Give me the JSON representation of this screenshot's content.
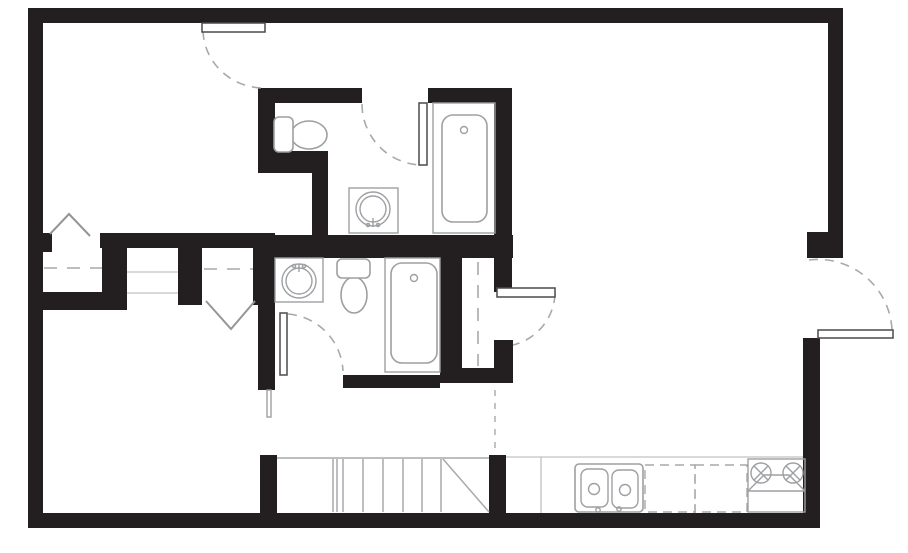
{
  "meta": {
    "title": "Residential floor plan drawing",
    "canvas_width": 908,
    "canvas_height": 553,
    "background": "#ffffff"
  },
  "colors": {
    "wall": "#231f20",
    "fixture_line": "#9d9fa2",
    "swing_arc": "#a7a9ac",
    "door_leaf_stroke": "#4a4a4c",
    "thin_line": "#b1b3b6",
    "background": "#ffffff"
  },
  "styles": {
    "wall": {
      "fill": "#231f20"
    },
    "leaf": {
      "fill": "#ffffff",
      "stroke": "#4a4a4c",
      "width": 1.5
    },
    "arc": {
      "stroke": "#a7a9ac",
      "width": 1.6,
      "dash": "9 7"
    },
    "chevron": {
      "stroke": "#939598",
      "width": 2
    },
    "shelf": {
      "stroke": "#a7a9ac",
      "width": 1.6,
      "dash": "13 10"
    },
    "dashsm": {
      "stroke": "#a7a9ac",
      "width": 1.4,
      "dash": "6 7"
    },
    "dashbox": {
      "stroke": "#a7a9ac",
      "width": 1.4,
      "dash": "9 6"
    },
    "fixture": {
      "fill": "#ffffff",
      "stroke": "#9d9fa2",
      "width": 1.6
    },
    "fixline": {
      "stroke": "#9d9fa2",
      "width": 1.4
    },
    "thin": {
      "stroke": "#b1b3b6",
      "width": 1.1
    },
    "tread": {
      "stroke": "#a7a9ac",
      "width": 1.5
    }
  },
  "layers": [
    {
      "name": "walls",
      "shapes": [
        {
          "n": "wall-exterior-top",
          "t": "rect",
          "x": 28,
          "y": 8,
          "width": 815,
          "height": 15,
          "st": "wall"
        },
        {
          "n": "wall-exterior-left",
          "t": "rect",
          "x": 28,
          "y": 8,
          "width": 15,
          "height": 520,
          "st": "wall"
        },
        {
          "n": "wall-exterior-bottom",
          "t": "rect",
          "x": 28,
          "y": 513,
          "width": 792,
          "height": 15,
          "st": "wall"
        },
        {
          "n": "wall-exterior-right-upper",
          "t": "rect",
          "x": 828,
          "y": 8,
          "width": 15,
          "height": 250,
          "st": "wall"
        },
        {
          "n": "wall-right-entry-jamb",
          "t": "rect",
          "x": 807,
          "y": 232,
          "width": 36,
          "height": 26,
          "st": "wall"
        },
        {
          "n": "wall-exterior-right-lower",
          "t": "rect",
          "x": 803,
          "y": 338,
          "width": 17,
          "height": 190,
          "st": "wall"
        },
        {
          "n": "wall-bath1-top-left",
          "t": "rect",
          "x": 258,
          "y": 88,
          "width": 104,
          "height": 15,
          "st": "wall"
        },
        {
          "n": "wall-bath1-top-right",
          "t": "rect",
          "x": 428,
          "y": 88,
          "width": 83,
          "height": 15,
          "st": "wall"
        },
        {
          "n": "wall-bath1-left",
          "t": "rect",
          "x": 258,
          "y": 88,
          "width": 17,
          "height": 63,
          "st": "wall"
        },
        {
          "n": "wall-bath1-jog-horizontal",
          "t": "rect",
          "x": 258,
          "y": 151,
          "width": 70,
          "height": 22,
          "st": "wall"
        },
        {
          "n": "wall-bath1-jog-vertical",
          "t": "rect",
          "x": 312,
          "y": 173,
          "width": 16,
          "height": 64,
          "st": "wall"
        },
        {
          "n": "wall-bath1-right",
          "t": "rect",
          "x": 494,
          "y": 88,
          "width": 18,
          "height": 204,
          "st": "wall"
        },
        {
          "n": "wall-middle-left",
          "t": "rect",
          "x": 100,
          "y": 233,
          "width": 175,
          "height": 15,
          "st": "wall"
        },
        {
          "n": "wall-middle-right",
          "t": "rect",
          "x": 263,
          "y": 235,
          "width": 250,
          "height": 23,
          "st": "wall"
        },
        {
          "n": "wall-closet1-door-stub",
          "t": "rect",
          "x": 43,
          "y": 233,
          "width": 9,
          "height": 19,
          "st": "wall"
        },
        {
          "n": "wall-closet1-right",
          "t": "rect",
          "x": 102,
          "y": 233,
          "width": 25,
          "height": 72,
          "st": "wall"
        },
        {
          "n": "wall-closet1-bottom",
          "t": "rect",
          "x": 43,
          "y": 292,
          "width": 84,
          "height": 18,
          "st": "wall"
        },
        {
          "n": "wall-hall-niche-right",
          "t": "rect",
          "x": 178,
          "y": 233,
          "width": 24,
          "height": 72,
          "st": "wall"
        },
        {
          "n": "wall-closet2-right",
          "t": "rect",
          "x": 253,
          "y": 235,
          "width": 15,
          "height": 70,
          "st": "wall"
        },
        {
          "n": "wall-bath2-left",
          "t": "rect",
          "x": 258,
          "y": 248,
          "width": 17,
          "height": 142,
          "st": "wall"
        },
        {
          "n": "wall-bath2-bottom",
          "t": "rect",
          "x": 343,
          "y": 375,
          "width": 97,
          "height": 13,
          "st": "wall"
        },
        {
          "n": "wall-bath2-right",
          "t": "rect",
          "x": 440,
          "y": 256,
          "width": 22,
          "height": 127,
          "st": "wall"
        },
        {
          "n": "wall-pantry-bottom",
          "t": "rect",
          "x": 440,
          "y": 368,
          "width": 73,
          "height": 15,
          "st": "wall"
        },
        {
          "n": "wall-pantry-right-lower",
          "t": "rect",
          "x": 494,
          "y": 340,
          "width": 19,
          "height": 43,
          "st": "wall"
        },
        {
          "n": "wall-stair-post-left",
          "t": "rect",
          "x": 260,
          "y": 455,
          "width": 17,
          "height": 58,
          "st": "wall"
        },
        {
          "n": "wall-stair-post-right",
          "t": "rect",
          "x": 489,
          "y": 455,
          "width": 17,
          "height": 58,
          "st": "wall"
        }
      ]
    },
    {
      "name": "closet-and-opening-details",
      "shapes": [
        {
          "n": "hall-niche-line-upper",
          "t": "line",
          "x1": 127,
          "y1": 272,
          "x2": 178,
          "y2": 272,
          "st": "thin"
        },
        {
          "n": "hall-niche-line-lower",
          "t": "line",
          "x1": 127,
          "y1": 293,
          "x2": 178,
          "y2": 293,
          "st": "thin"
        },
        {
          "n": "closet1-shelf-dashed",
          "t": "line",
          "x1": 44,
          "y1": 268,
          "x2": 102,
          "y2": 268,
          "st": "shelf"
        },
        {
          "n": "closet2-shelf-dashed",
          "t": "line",
          "x1": 204,
          "y1": 269,
          "x2": 253,
          "y2": 269,
          "st": "shelf"
        },
        {
          "n": "pantry-shelf-dashed",
          "t": "line",
          "x1": 478,
          "y1": 262,
          "x2": 478,
          "y2": 366,
          "st": "shelf"
        },
        {
          "n": "kitchen-boundary-dashed",
          "t": "line",
          "x1": 495,
          "y1": 390,
          "x2": 495,
          "y2": 453,
          "st": "dashsm"
        },
        {
          "n": "bath2-wall-end-cap",
          "t": "rect",
          "x": 267,
          "y": 390,
          "width": 4,
          "height": 27,
          "st": "fixline"
        }
      ]
    },
    {
      "name": "bathroom-upper-fixtures",
      "shapes": [
        {
          "n": "bath1-tub-enclosure",
          "t": "rect",
          "x": 433,
          "y": 103,
          "width": 62,
          "height": 130,
          "st": "fixline"
        },
        {
          "n": "bath1-bathtub",
          "t": "rect",
          "x": 442,
          "y": 115,
          "width": 45,
          "height": 107,
          "rx": 11,
          "st": "fixture"
        },
        {
          "n": "bath1-tub-faucet",
          "t": "circle",
          "cx": 464,
          "cy": 130,
          "r": 3.5,
          "st": "fixline"
        },
        {
          "n": "bath1-toilet-bowl",
          "t": "ellipse",
          "cx": 309,
          "cy": 135,
          "rx": 18,
          "ry": 14,
          "st": "fixture"
        },
        {
          "n": "bath1-toilet-tank",
          "t": "rect",
          "x": 274,
          "y": 117,
          "width": 19,
          "height": 35,
          "rx": 5,
          "st": "fixture"
        },
        {
          "n": "bath1-vanity",
          "t": "rect",
          "x": 349,
          "y": 188,
          "width": 49,
          "height": 45,
          "st": "fixline"
        },
        {
          "n": "bath1-sink-outer",
          "t": "circle",
          "cx": 373,
          "cy": 209,
          "r": 17,
          "st": "fixline"
        },
        {
          "n": "bath1-sink-inner",
          "t": "circle",
          "cx": 373,
          "cy": 209,
          "r": 13,
          "st": "fixline"
        },
        {
          "n": "bath1-sink-faucet-stem",
          "t": "line",
          "x1": 373,
          "y1": 218,
          "x2": 373,
          "y2": 227,
          "st": "fixline"
        },
        {
          "n": "bath1-sink-faucet-dot-left",
          "t": "circle",
          "cx": 368,
          "cy": 225,
          "r": 1.6,
          "st": "fixline"
        },
        {
          "n": "bath1-sink-faucet-dot-right",
          "t": "circle",
          "cx": 378,
          "cy": 225,
          "r": 1.6,
          "st": "fixline"
        }
      ]
    },
    {
      "name": "bathroom-lower-fixtures",
      "shapes": [
        {
          "n": "bath2-vanity",
          "t": "rect",
          "x": 275,
          "y": 258,
          "width": 48,
          "height": 44,
          "st": "fixline"
        },
        {
          "n": "bath2-sink-outer",
          "t": "circle",
          "cx": 299,
          "cy": 281,
          "r": 17,
          "st": "fixline"
        },
        {
          "n": "bath2-sink-inner",
          "t": "circle",
          "cx": 299,
          "cy": 281,
          "r": 13,
          "st": "fixline"
        },
        {
          "n": "bath2-sink-faucet-stem",
          "t": "line",
          "x1": 299,
          "y1": 264,
          "x2": 299,
          "y2": 272,
          "st": "fixline"
        },
        {
          "n": "bath2-sink-faucet-dot-left",
          "t": "circle",
          "cx": 294,
          "cy": 266,
          "r": 1.6,
          "st": "fixline"
        },
        {
          "n": "bath2-sink-faucet-dot-right",
          "t": "circle",
          "cx": 304,
          "cy": 266,
          "r": 1.6,
          "st": "fixline"
        },
        {
          "n": "bath2-toilet-bowl",
          "t": "ellipse",
          "cx": 354,
          "cy": 295,
          "rx": 13,
          "ry": 18,
          "st": "fixture"
        },
        {
          "n": "bath2-toilet-tank",
          "t": "rect",
          "x": 337,
          "y": 259,
          "width": 33,
          "height": 19,
          "rx": 5,
          "st": "fixture"
        },
        {
          "n": "bath2-tub-enclosure",
          "t": "rect",
          "x": 385,
          "y": 258,
          "width": 55,
          "height": 114,
          "st": "fixline"
        },
        {
          "n": "bath2-bathtub",
          "t": "rect",
          "x": 391,
          "y": 263,
          "width": 46,
          "height": 100,
          "rx": 11,
          "st": "fixture"
        },
        {
          "n": "bath2-tub-faucet",
          "t": "circle",
          "cx": 414,
          "cy": 278,
          "r": 3.5,
          "st": "fixline"
        }
      ]
    },
    {
      "name": "kitchen",
      "shapes": [
        {
          "n": "kitchen-counter-edge",
          "t": "line",
          "x1": 506,
          "y1": 457,
          "x2": 803,
          "y2": 457,
          "st": "thin"
        },
        {
          "n": "kitchen-counter-divider",
          "t": "line",
          "x1": 541,
          "y1": 457,
          "x2": 541,
          "y2": 513,
          "st": "thin"
        },
        {
          "n": "kitchen-sink-unit",
          "t": "rect",
          "x": 575,
          "y": 464,
          "width": 68,
          "height": 48,
          "rx": 4,
          "st": "fixture"
        },
        {
          "n": "kitchen-sink-basin-left",
          "t": "rect",
          "x": 581,
          "y": 469,
          "width": 27,
          "height": 38,
          "rx": 7,
          "st": "fixline"
        },
        {
          "n": "kitchen-sink-basin-right",
          "t": "rect",
          "x": 612,
          "y": 470,
          "width": 26,
          "height": 38,
          "rx": 7,
          "st": "fixline"
        },
        {
          "n": "kitchen-sink-drain-left",
          "t": "circle",
          "cx": 594,
          "cy": 489,
          "r": 5.5,
          "st": "fixline"
        },
        {
          "n": "kitchen-sink-drain-right",
          "t": "circle",
          "cx": 625,
          "cy": 490,
          "r": 5.5,
          "st": "fixline"
        },
        {
          "n": "kitchen-sink-faucet-left",
          "t": "circle",
          "cx": 598,
          "cy": 510,
          "r": 2.2,
          "st": "fixline"
        },
        {
          "n": "kitchen-sink-faucet-right",
          "t": "circle",
          "cx": 619,
          "cy": 509,
          "r": 2.2,
          "st": "fixline"
        },
        {
          "n": "kitchen-appliance-dashed-1",
          "t": "rect",
          "x": 645,
          "y": 465,
          "width": 50,
          "height": 47,
          "st": "dashbox"
        },
        {
          "n": "kitchen-appliance-dashed-2",
          "t": "rect",
          "x": 695,
          "y": 465,
          "width": 52,
          "height": 47,
          "st": "dashbox"
        },
        {
          "n": "range-outline",
          "t": "rect",
          "x": 748,
          "y": 459,
          "width": 57,
          "height": 53,
          "st": "fixline"
        },
        {
          "n": "range-burner-left",
          "t": "circle",
          "cx": 761,
          "cy": 473,
          "r": 10,
          "st": "fixline"
        },
        {
          "n": "range-burner-left-x1",
          "t": "line",
          "x1": 754,
          "y1": 466,
          "x2": 768,
          "y2": 480,
          "st": "fixline"
        },
        {
          "n": "range-burner-left-x2",
          "t": "line",
          "x1": 754,
          "y1": 480,
          "x2": 768,
          "y2": 466,
          "st": "fixline"
        },
        {
          "n": "range-burner-right",
          "t": "circle",
          "cx": 793,
          "cy": 473,
          "r": 10,
          "st": "fixline"
        },
        {
          "n": "range-burner-right-x1",
          "t": "line",
          "x1": 786,
          "y1": 466,
          "x2": 800,
          "y2": 480,
          "st": "fixline"
        },
        {
          "n": "range-burner-right-x2",
          "t": "line",
          "x1": 786,
          "y1": 480,
          "x2": 800,
          "y2": 466,
          "st": "fixline"
        },
        {
          "n": "range-front-panel",
          "t": "polyline",
          "points": "748,491 764,475 789,475 805,491",
          "st": "fixline"
        },
        {
          "n": "range-front-line",
          "t": "line",
          "x1": 748,
          "y1": 491,
          "x2": 805,
          "y2": 491,
          "st": "fixline"
        }
      ]
    },
    {
      "name": "staircase",
      "shapes": [
        {
          "n": "stair-top-edge",
          "t": "line",
          "x1": 277,
          "y1": 458,
          "x2": 489,
          "y2": 458,
          "st": "tread"
        },
        {
          "n": "stair-tread-1",
          "t": "line",
          "x1": 333,
          "y1": 459,
          "x2": 333,
          "y2": 512,
          "st": "tread"
        },
        {
          "n": "stair-tread-2",
          "t": "line",
          "x1": 337,
          "y1": 459,
          "x2": 337,
          "y2": 512,
          "st": "tread"
        },
        {
          "n": "stair-tread-3",
          "t": "line",
          "x1": 343,
          "y1": 459,
          "x2": 343,
          "y2": 512,
          "st": "tread"
        },
        {
          "n": "stair-tread-4",
          "t": "line",
          "x1": 363,
          "y1": 459,
          "x2": 363,
          "y2": 512,
          "st": "tread"
        },
        {
          "n": "stair-tread-5",
          "t": "line",
          "x1": 383,
          "y1": 459,
          "x2": 383,
          "y2": 512,
          "st": "tread"
        },
        {
          "n": "stair-tread-6",
          "t": "line",
          "x1": 403,
          "y1": 459,
          "x2": 403,
          "y2": 512,
          "st": "tread"
        },
        {
          "n": "stair-tread-7",
          "t": "line",
          "x1": 422,
          "y1": 459,
          "x2": 422,
          "y2": 512,
          "st": "tread"
        },
        {
          "n": "stair-tread-8",
          "t": "line",
          "x1": 441,
          "y1": 459,
          "x2": 441,
          "y2": 512,
          "st": "tread"
        },
        {
          "n": "stair-diagonal",
          "t": "line",
          "x1": 443,
          "y1": 459,
          "x2": 489,
          "y2": 512,
          "st": "tread"
        }
      ]
    },
    {
      "name": "doors",
      "shapes": [
        {
          "n": "door-swing-top-entry",
          "t": "path",
          "d": "M 203 31 A 61 59 0 0 0 263 88",
          "st": "arc"
        },
        {
          "n": "door-swing-bath1",
          "t": "path",
          "d": "M 362 104 A 61 61 0 0 0 423 165",
          "st": "arc"
        },
        {
          "n": "door-swing-bath2",
          "t": "path",
          "d": "M 288 314 A 60 60 0 0 1 343 371",
          "st": "arc"
        },
        {
          "n": "door-swing-pantry",
          "t": "path",
          "d": "M 555 294 A 55 55 0 0 1 513 345",
          "st": "arc"
        },
        {
          "n": "door-swing-right-entry",
          "t": "path",
          "d": "M 809 260 A 74 74 0 0 1 892 330",
          "st": "arc"
        },
        {
          "n": "door-leaf-top-entry",
          "t": "rect",
          "x": 202,
          "y": 23,
          "width": 63,
          "height": 9,
          "st": "leaf"
        },
        {
          "n": "door-leaf-bath1",
          "t": "rect",
          "x": 419,
          "y": 103,
          "width": 8,
          "height": 62,
          "st": "leaf"
        },
        {
          "n": "door-leaf-bath2",
          "t": "rect",
          "x": 280,
          "y": 313,
          "width": 7,
          "height": 62,
          "st": "leaf"
        },
        {
          "n": "door-leaf-pantry",
          "t": "rect",
          "x": 497,
          "y": 288,
          "width": 58,
          "height": 9,
          "st": "leaf"
        },
        {
          "n": "door-leaf-right-entry",
          "t": "rect",
          "x": 818,
          "y": 330,
          "width": 75,
          "height": 8,
          "st": "leaf"
        },
        {
          "n": "closet1-bifold-door",
          "t": "polyline",
          "points": "50,234 69,214 90,236",
          "st": "chevron"
        },
        {
          "n": "closet2-bifold-door",
          "t": "polyline",
          "points": "206,301 231,329 255,301",
          "st": "chevron"
        }
      ]
    }
  ]
}
